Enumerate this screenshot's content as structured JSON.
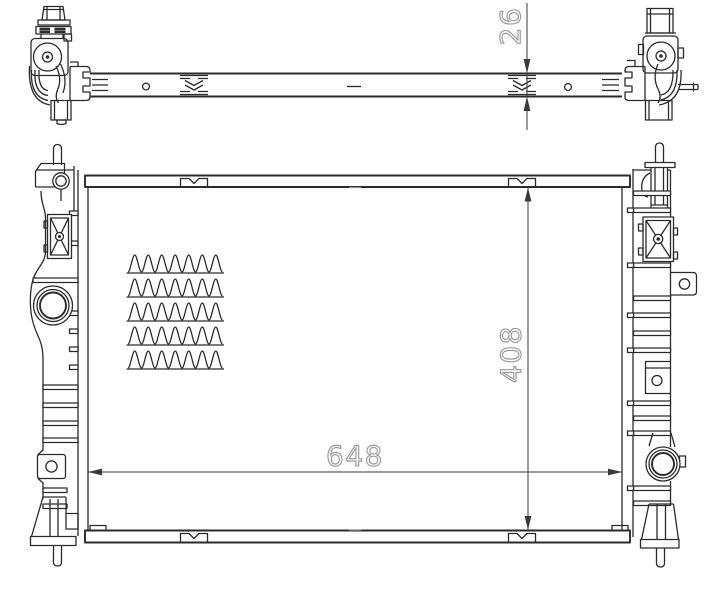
{
  "dimensions": {
    "depth": "26",
    "width": "648",
    "height": "408"
  },
  "colors": {
    "line": "#2b2b2b",
    "dim_line": "#3a3a3a",
    "dim_text": "#9a9a9a",
    "background": "#ffffff"
  }
}
